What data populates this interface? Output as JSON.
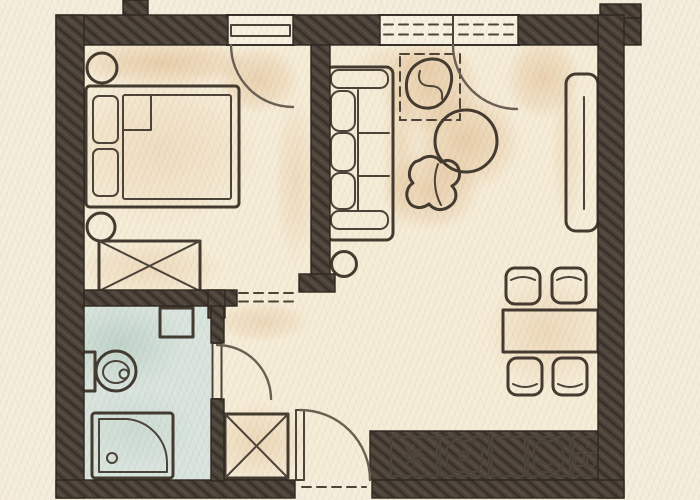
{
  "title": "Hand-drawn apartment floor plan sketch",
  "colors": {
    "paper": "#f5eedd",
    "floor": "#f6edd8",
    "wall": "#4c433a",
    "wall_hatch_dark": "#39312a",
    "wall_hatch_light": "#5d5145",
    "outline": "#443b31",
    "bathroom_floor": "#d9e5de",
    "mattress": "#d4e1da",
    "fixture_white": "#f6f1e2",
    "wood_cream": "#f0e5cb",
    "furniture_tan": "#e9d2a7",
    "table_tan": "#e2bf93",
    "counter_cream": "#efe8d4",
    "counter_plain": "#eadfc2",
    "shade_tan": "#d7a873",
    "shade_blue": "#9dbbb0"
  },
  "scene": {
    "type": "floor-plan-sketch",
    "rooms": [
      {
        "name": "bedroom",
        "items": [
          "double-bed",
          "mattress",
          "pillow",
          "pillow",
          "folded-sheet",
          "nightstand",
          "nightstand",
          "wardrobe-crossed"
        ]
      },
      {
        "name": "living-room",
        "items": [
          "sofa",
          "armchair-top",
          "armchair-bottom",
          "round-coffee-table",
          "sideboard",
          "stool"
        ]
      },
      {
        "name": "hallway",
        "items": [
          "storage-cabinet-crossed"
        ]
      },
      {
        "name": "bathroom",
        "items": [
          "washbasin",
          "toilet",
          "shower-tray"
        ]
      },
      {
        "name": "dining-area",
        "items": [
          "dining-table",
          "chair",
          "chair",
          "chair",
          "chair"
        ]
      },
      {
        "name": "kitchen",
        "items": [
          "cooktop-star",
          "sink-basin",
          "counter-segment",
          "appliance-basin",
          "hob-two-burners"
        ]
      }
    ],
    "openings": {
      "doors": [
        "bedroom-door",
        "entry-door",
        "bathroom-door",
        "balcony-door"
      ],
      "window_sections": 1,
      "dashed-passages": 2
    }
  }
}
